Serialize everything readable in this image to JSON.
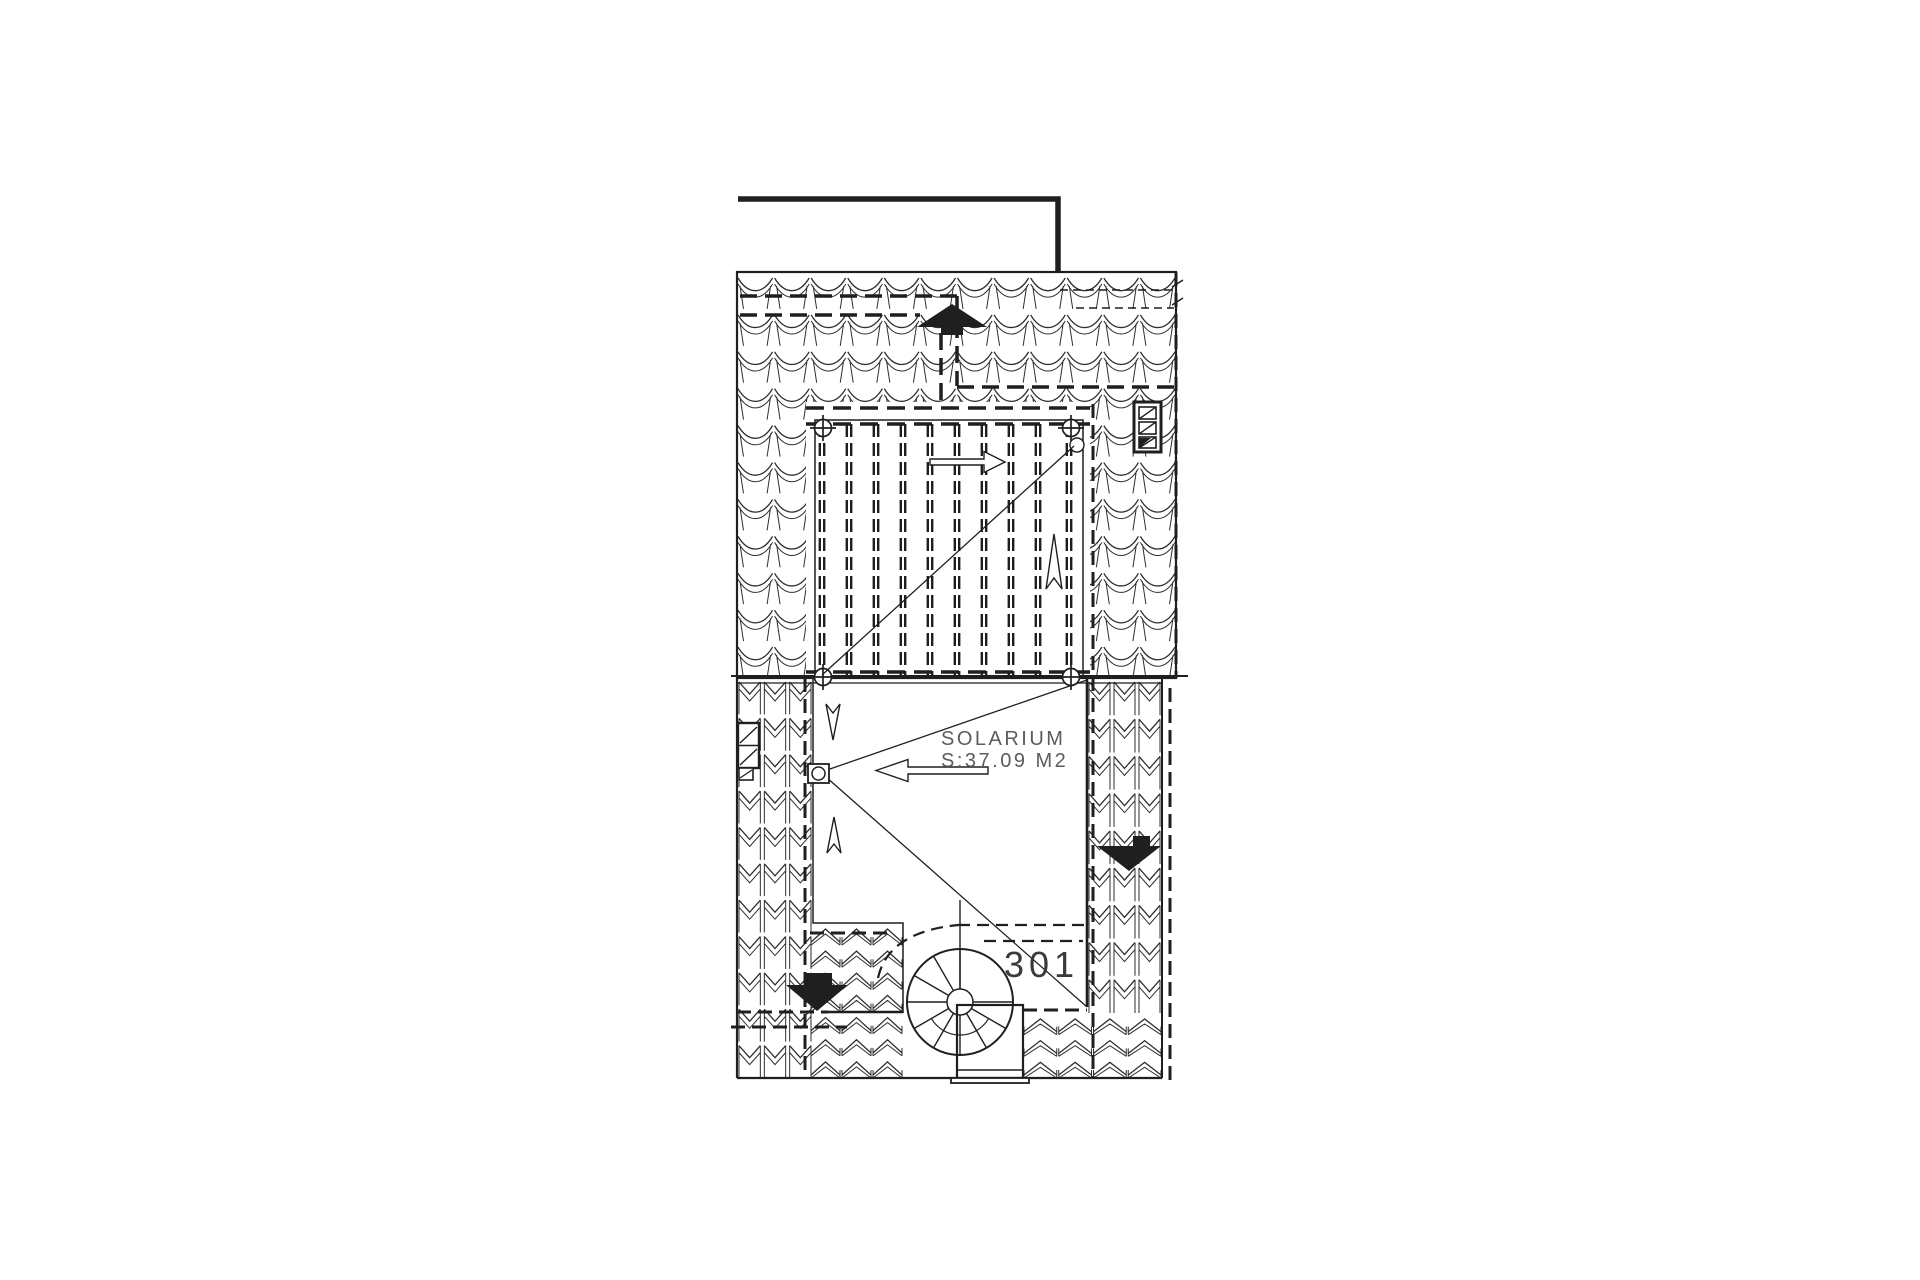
{
  "document": {
    "type": "architectural roof plan",
    "labels": {
      "room_name": "SOLARIUM",
      "room_area": "S:37.09 M2",
      "room_number": "301"
    },
    "colors": {
      "ink": "#1f1f1f",
      "tile_line": "#2e2e2e",
      "annotation_gray": "#5c5c5c",
      "background": "#ffffff"
    },
    "icons": [
      "flow-arrow-up-filled-icon",
      "flow-arrow-down-filled-left-icon",
      "flow-arrow-down-filled-right-icon",
      "open-arrow-right-icon",
      "open-arrow-left-icon",
      "open-arrow-up-icon",
      "open-arrow-down-icon",
      "vent-grille-icon",
      "spiral-stair-icon",
      "corner-post-marker-icon",
      "survey-point-marker-icon"
    ]
  }
}
